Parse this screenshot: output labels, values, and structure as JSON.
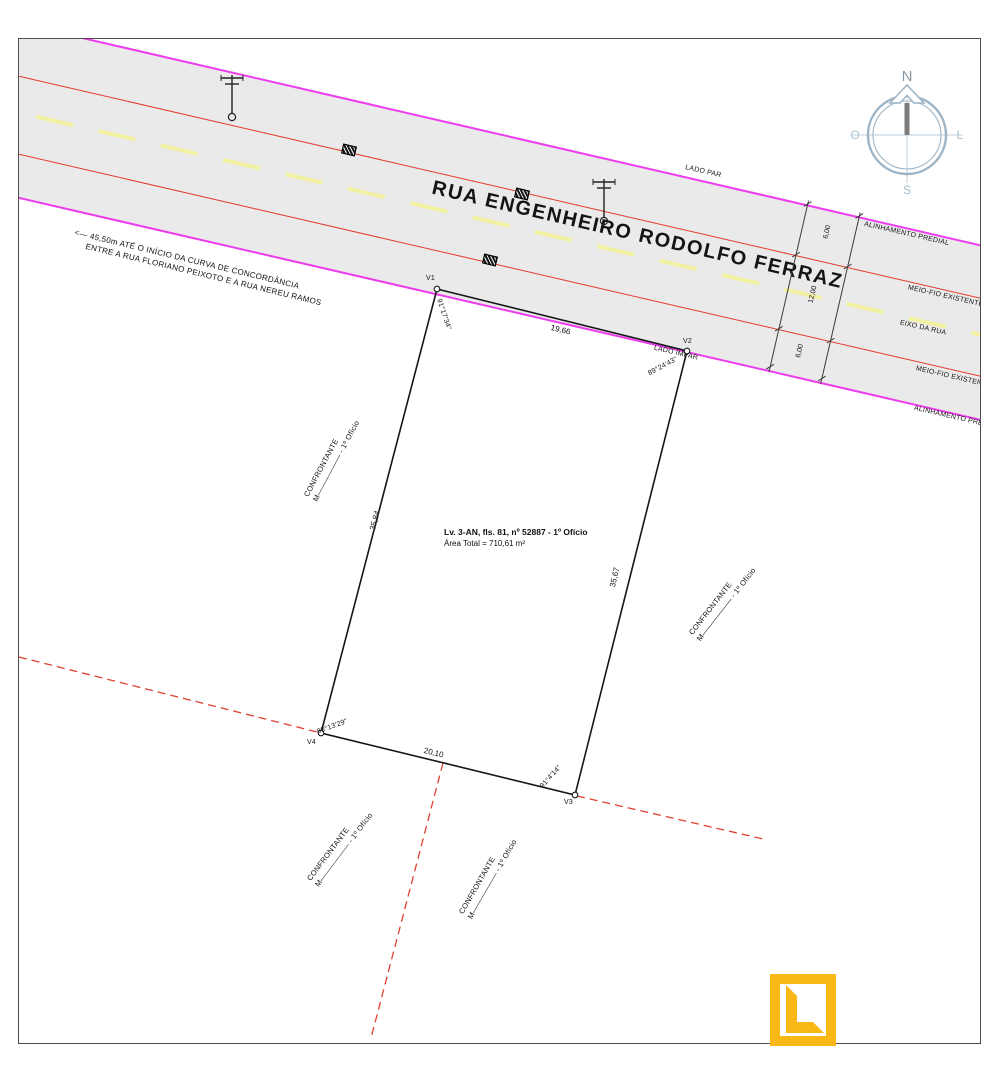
{
  "compass": {
    "north": "N",
    "south": "S",
    "west": "O",
    "east": "L"
  },
  "street": {
    "name": "RUA ENGENHEIRO RODOLFO FERRAZ",
    "lado_par": "LADO PAR",
    "lado_impar": "LADO IMPAR",
    "alinhamento_top": "ALINHAMENTO PREDIAL",
    "meio_fio_top": "MEIO-FIO EXISTENTE",
    "eixo": "EIXO DA RUA",
    "meio_fio_bottom": "MEIO-FIO EXISTENTE",
    "alinhamento_bottom": "ALINHAMENTO PREDIAL",
    "cross_dims": [
      "6,00",
      "12,00",
      "6,00"
    ]
  },
  "annotation": {
    "line1": "<—  45,50m ATÉ O INÍCIO DA CURVA DE CONCORDÂNCIA",
    "line2": "ENTRE A RUA FLORIANO PEIXOTO E A RUA NEREU RAMOS"
  },
  "lot": {
    "registry": "Lv. 3-AN, fls. 81, nº 52887 - 1º Ofício",
    "area_total": "Área Total = 710,61 m²",
    "vertices": [
      {
        "id": "V1",
        "angle": "91°17'34\""
      },
      {
        "id": "V2",
        "angle": "89°24'43\""
      },
      {
        "id": "V3",
        "angle": "91°4'14\""
      },
      {
        "id": "V4",
        "angle": "88°13'29\""
      }
    ],
    "dimensions": {
      "front": "19,66",
      "left": "35,84",
      "right": "35,67",
      "back": "20,10"
    }
  },
  "confrontante": {
    "line1": "CONFRONTANTE",
    "line2": "M—————— - 1º Ofício"
  },
  "colors": {
    "street_fill": "#eaeaea",
    "alignment_line": "#ee3cee",
    "curb_line": "#e23b28",
    "axis_line": "#f2f0a2",
    "boundary_dashed": "#e04133",
    "logo": "#f9b815",
    "compass": "#9cb4c6"
  }
}
